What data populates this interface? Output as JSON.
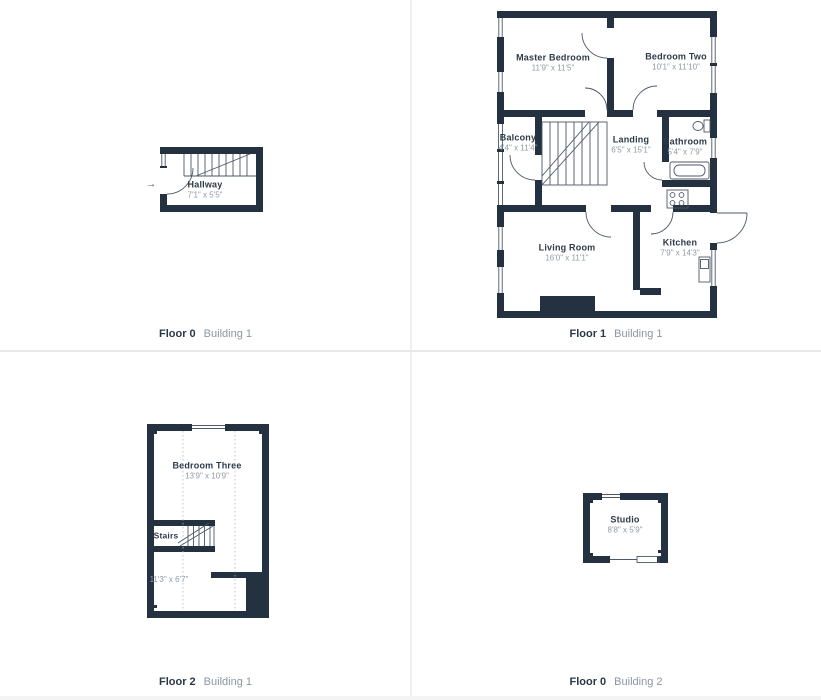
{
  "colors": {
    "wall": "#243140",
    "thin_line": "#4d5968",
    "room_name_text": "#2c3a49",
    "room_dims_text": "#8f99a6",
    "floor_text": "#2b3947",
    "building_text": "#8b95a3",
    "divider": "#e8e8e8",
    "background": "#ffffff"
  },
  "icons": {
    "entry_arrow": "→"
  },
  "panels": [
    {
      "caption": {
        "floor": "Floor 0",
        "building": "Building 1"
      },
      "rooms": [
        {
          "name": "Hallway",
          "dims": "7'1\" x 5'5\""
        }
      ]
    },
    {
      "caption": {
        "floor": "Floor 1",
        "building": "Building 1"
      },
      "rooms": [
        {
          "name": "Master Bedroom",
          "dims": "11'9\" x 11'5\""
        },
        {
          "name": "Bedroom Two",
          "dims": "10'1\" x 11'10\""
        },
        {
          "name": "Balcony",
          "dims": "4'4\" x 11'4\""
        },
        {
          "name": "Landing",
          "dims": "6'5\" x 15'1\""
        },
        {
          "name": "Bathroom",
          "dims": "5'4\" x 7'9\""
        },
        {
          "name": "Living Room",
          "dims": "16'0\" x 11'1\""
        },
        {
          "name": "Kitchen",
          "dims": "7'9\" x 14'3\""
        }
      ]
    },
    {
      "caption": {
        "floor": "Floor 2",
        "building": "Building 1"
      },
      "rooms": [
        {
          "name": "Bedroom Three",
          "dims": "13'9\" x 10'9\""
        },
        {
          "name": "Stairs",
          "dims": ""
        },
        {
          "name": "",
          "dims": "11'3\" x 6'7\""
        }
      ]
    },
    {
      "caption": {
        "floor": "Floor 0",
        "building": "Building 2"
      },
      "rooms": [
        {
          "name": "Studio",
          "dims": "8'8\" x 5'9\""
        }
      ]
    }
  ]
}
